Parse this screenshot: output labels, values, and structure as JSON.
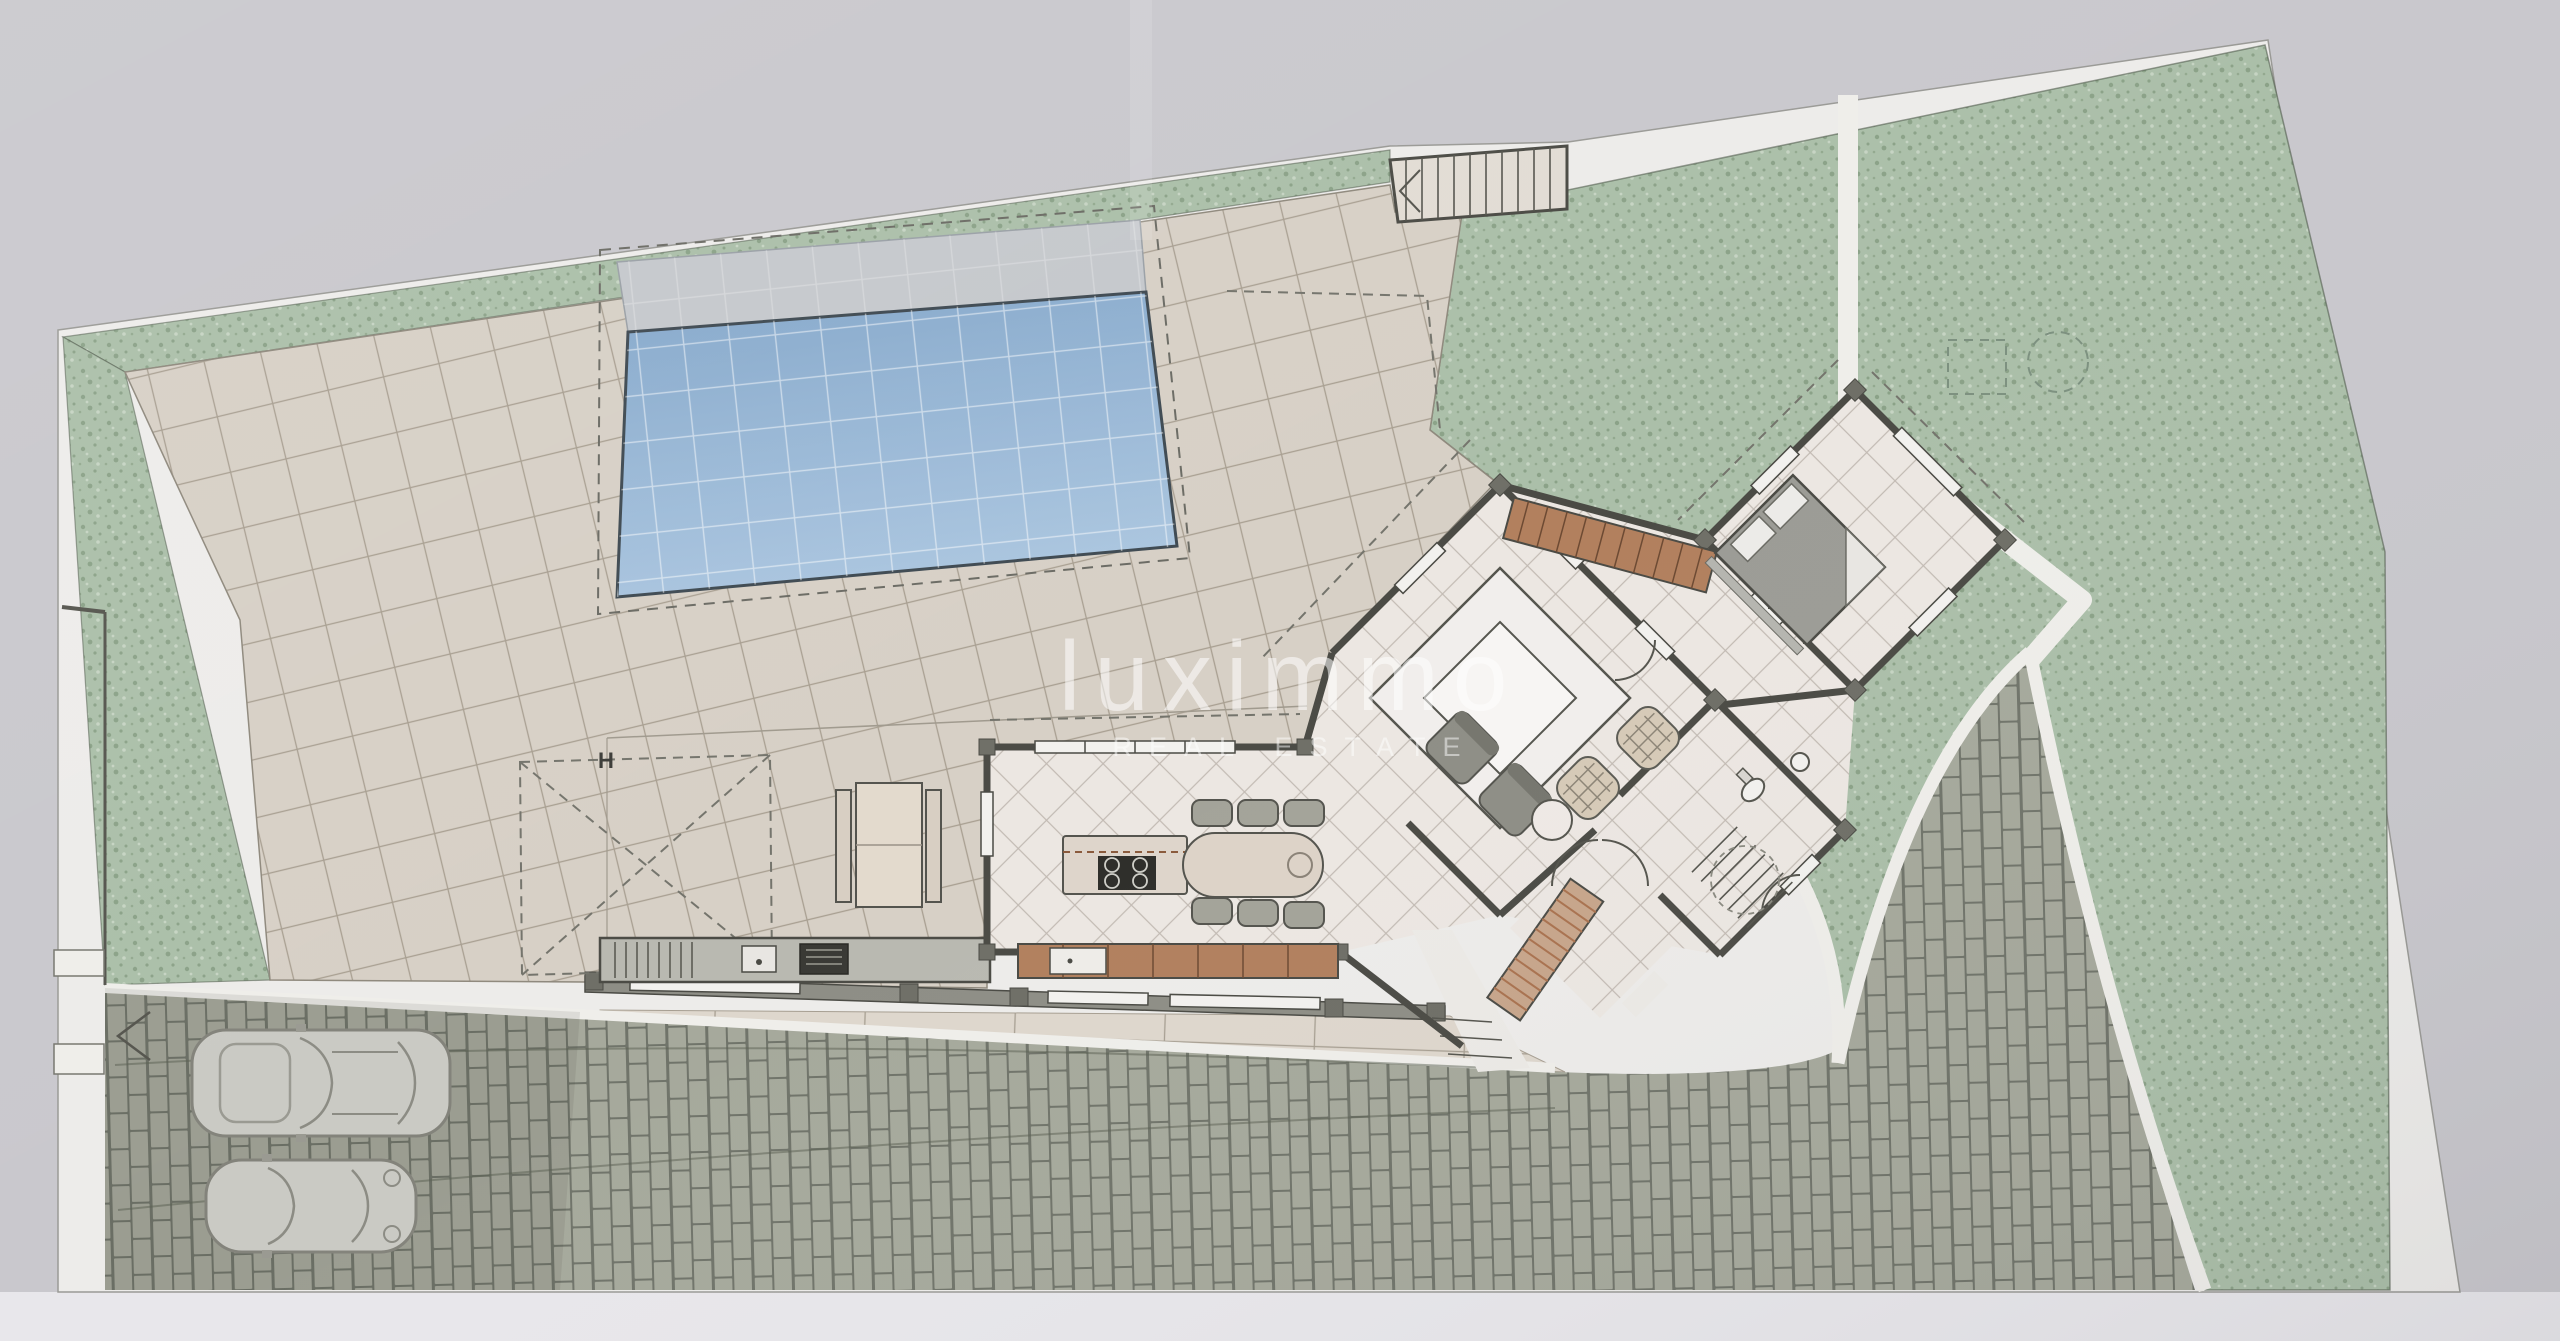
{
  "document": {
    "kind": "scanned architectural site plan",
    "view": "villa ground floor with garden, pool and parking"
  },
  "watermark": {
    "brand": "luximmo",
    "tagline": "REAL ESTATE"
  },
  "annotations": {
    "carport_label": "H",
    "stair_treads_top": 11,
    "parked_cars": 2
  },
  "regions": {
    "labels": [
      "garden",
      "terrace",
      "swimming-pool",
      "top-stairs",
      "house",
      "living-room",
      "bedroom",
      "kitchen",
      "bathroom",
      "entry-porch",
      "driveway",
      "parking",
      "outdoor-kitchen",
      "pergola",
      "garden-paths"
    ]
  },
  "colors": {
    "paper": "#c9c8cd",
    "margin_white": "#edecea",
    "terrace_tile": "#d7d0c6",
    "tile_grout": "#a89f91",
    "garden_green": "#abbfa9",
    "garden_speckle": "#8ba288",
    "pool_deep": "#84a7ca",
    "pool_shallow": "#aac5df",
    "pool_deck": "#c5c8cc",
    "brick": "#a6a99c",
    "brick_gap": "#70746a",
    "wall_dark": "#4b4b45",
    "wall_light": "#8e8e86",
    "floor": "#ece7e2",
    "floor_grid": "#c2bab3",
    "slab": "#ded7cd",
    "furniture_brown": "#b2805e",
    "furniture_gray": "#8e8e86",
    "bed_gray": "#9c9c96",
    "wicker": "#d6cab7",
    "car_body": "#cacac4",
    "counter_gray": "#b9b9b1",
    "bbq_dark": "#3a3a35",
    "watermark": "#ffffff"
  }
}
